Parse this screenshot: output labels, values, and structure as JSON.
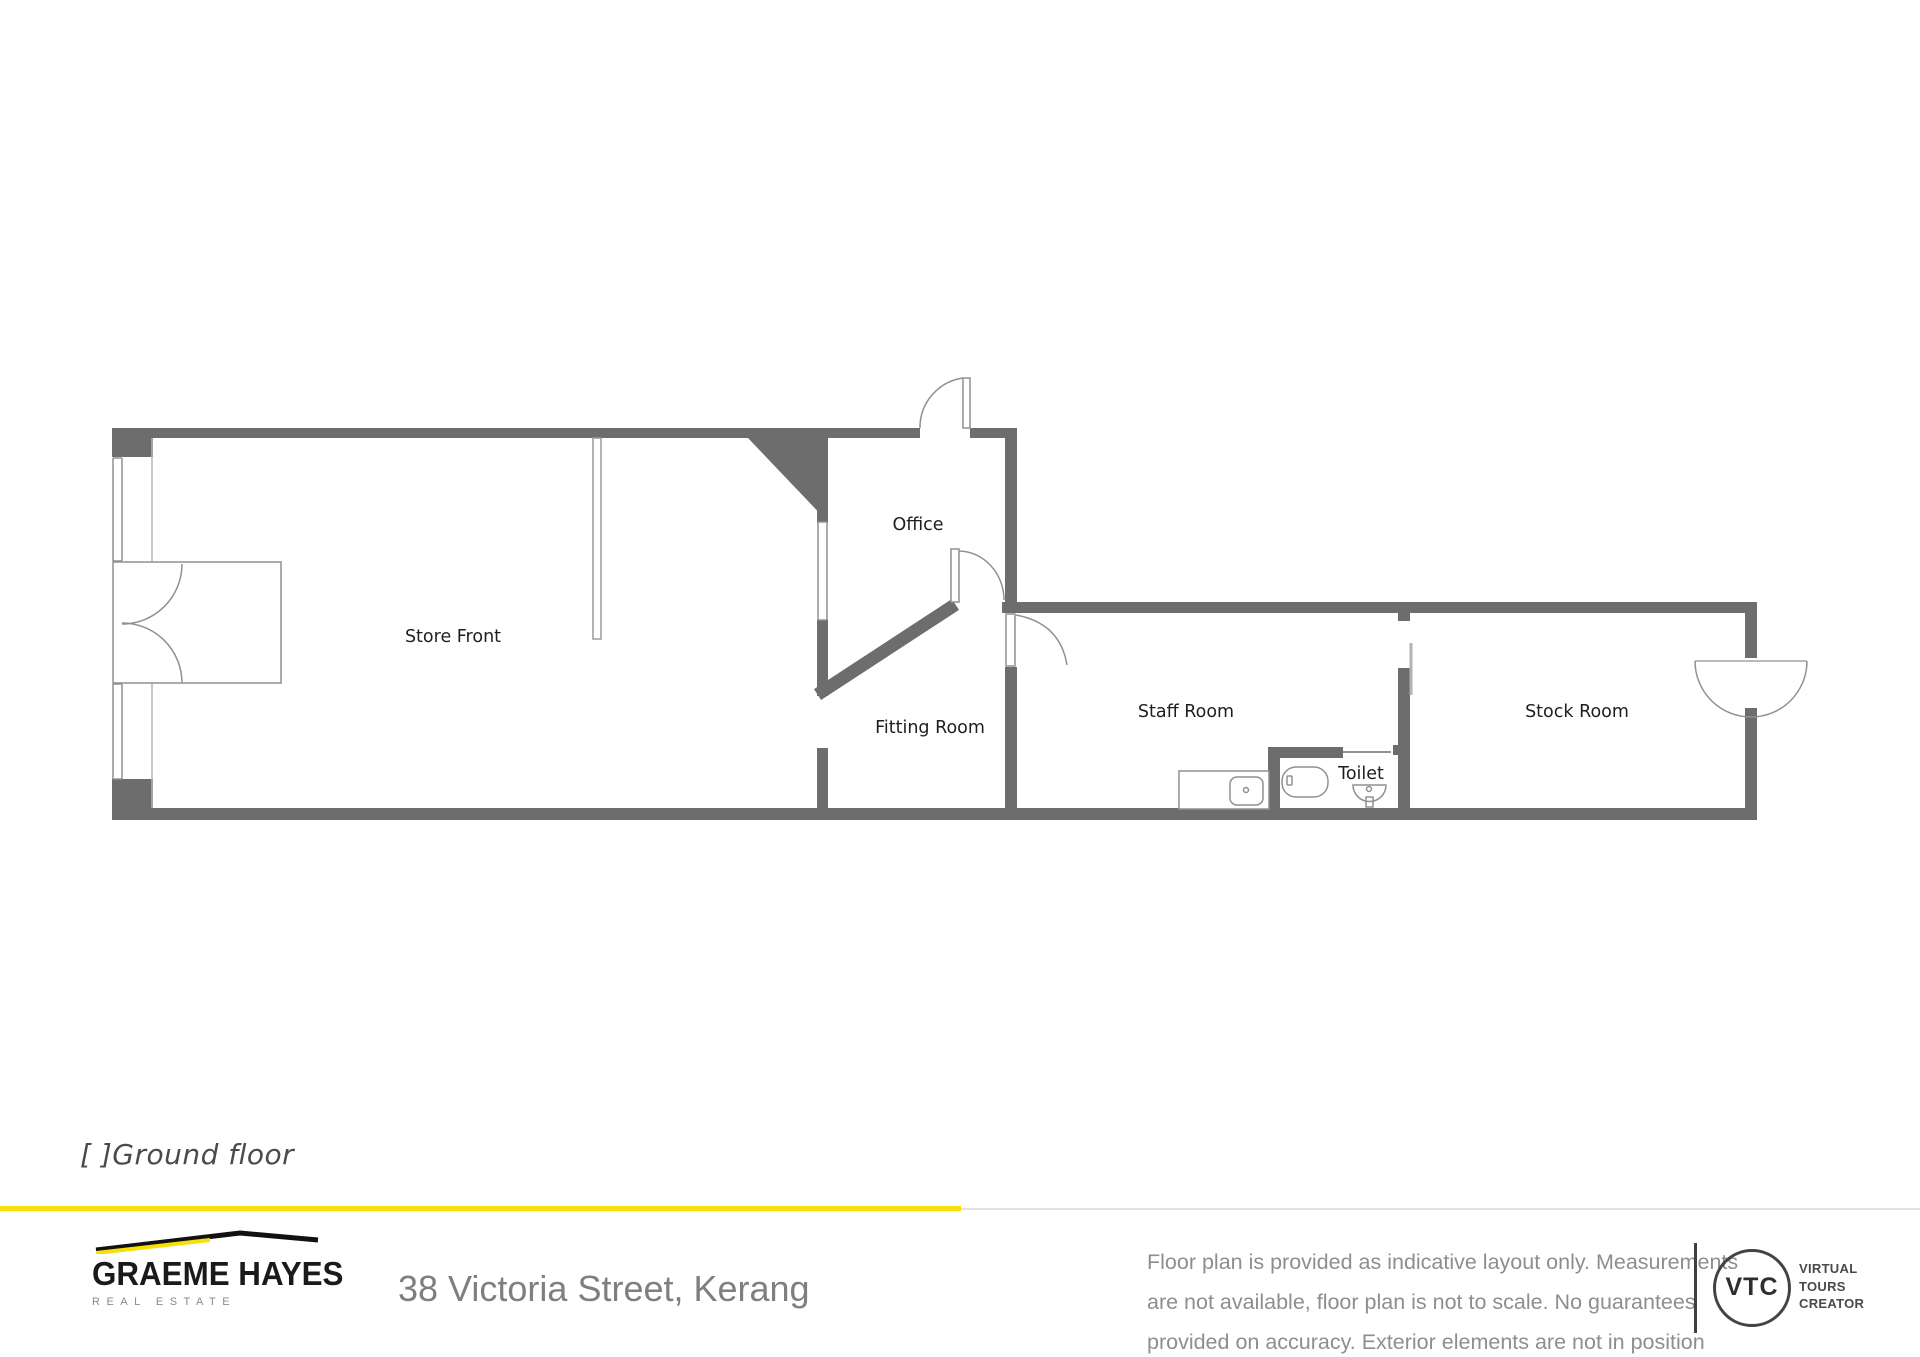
{
  "floor_plan": {
    "level_label": "[ ]Ground floor",
    "rooms": [
      {
        "name": "Store Front"
      },
      {
        "name": "Office"
      },
      {
        "name": "Fitting Room"
      },
      {
        "name": "Staff Room"
      },
      {
        "name": "Toilet"
      },
      {
        "name": "Stock Room"
      }
    ],
    "colors": {
      "wall": "#6d6d6d",
      "fixture_line": "#909090"
    }
  },
  "footer": {
    "brand": {
      "name": "GRAEME HAYES",
      "tagline": "REAL ESTATE"
    },
    "address": "38 Victoria Street, Kerang",
    "disclaimer_lines": [
      "Floor plan is provided as indicative layout only. Measurements",
      "are not available, floor plan is not to scale. No guarantees",
      "provided on accuracy. Exterior elements are not in position"
    ],
    "vtc": {
      "abbr": "VTC",
      "words": [
        "VIRTUAL",
        "TOURS",
        "CREATOR"
      ]
    },
    "colors": {
      "accent": "#F6DF0A",
      "divider_gray": "#e1e1e1"
    }
  }
}
